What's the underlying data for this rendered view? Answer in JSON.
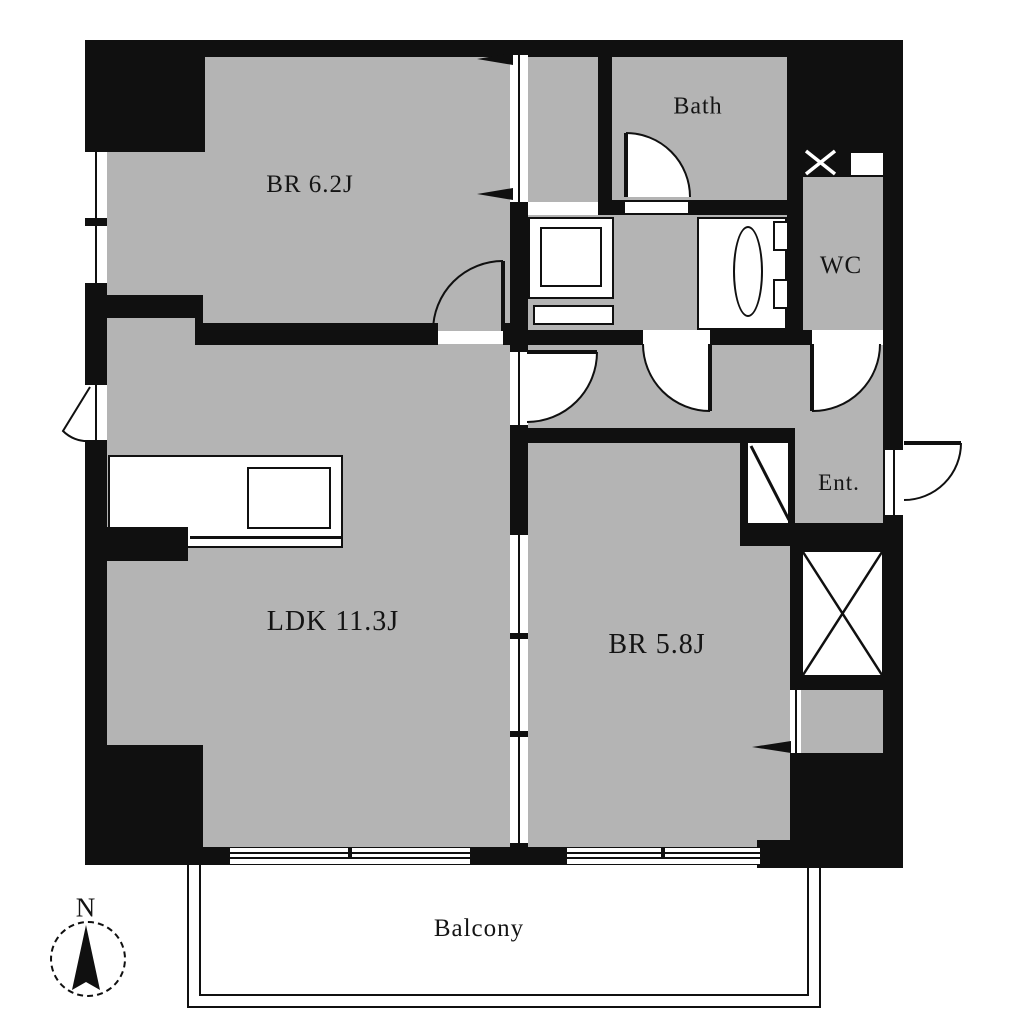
{
  "floorplan": {
    "wall_color": "#101010",
    "room_fill": "#b4b4b4",
    "background": "#ffffff",
    "rooms": {
      "bedroom1": {
        "label": "BR 6.2J"
      },
      "bath": {
        "label": "Bath"
      },
      "wc": {
        "label": "WC"
      },
      "entrance": {
        "label": "Ent."
      },
      "ldk": {
        "label": "LDK 11.3J"
      },
      "bedroom2": {
        "label": "BR 5.8J"
      },
      "balcony": {
        "label": "Balcony"
      }
    },
    "compass": {
      "north_label": "N"
    }
  }
}
